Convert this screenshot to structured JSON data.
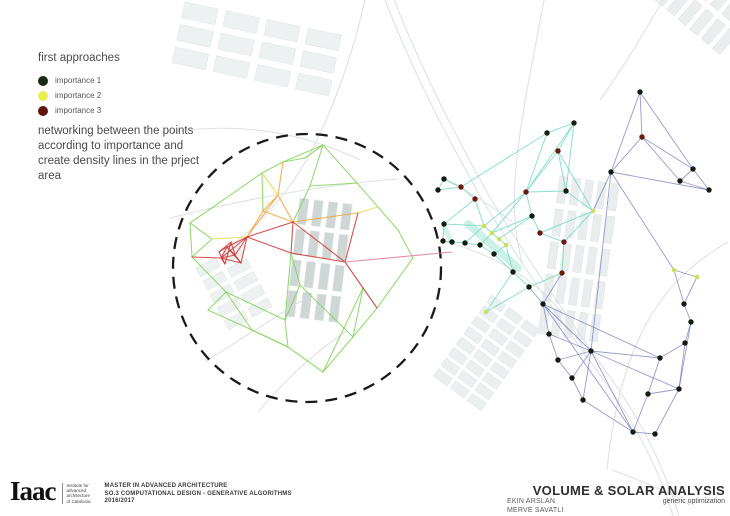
{
  "legend": {
    "title": "first approaches",
    "items": [
      {
        "label": "importance 1",
        "color": "#1a2a12"
      },
      {
        "label": "importance 2",
        "color": "#e9ee52"
      },
      {
        "label": "importance 3",
        "color": "#5f150d"
      }
    ]
  },
  "description": "networking between the points according to importance and create density lines in the prject area",
  "footer": {
    "logo_text": "Iaac",
    "institute_lines": [
      "Institute for",
      "advanced",
      "architecture",
      "of Catalonia"
    ],
    "program_lines": [
      "MASTER IN ADVANCED ARCHITECTURE",
      "SO.3 COMPUTATIONAL DESIGN - GENERATIVE ALGORITHMS",
      "2016/2017"
    ]
  },
  "titleblock": {
    "title": "VOLUME & SOLAR ANALYSIS",
    "subtitle": "generic optimization",
    "credits": [
      "EKIN ARSLAN",
      "MERVE SAVATLI"
    ]
  },
  "chart_data": {
    "type": "network-diagram-over-map",
    "project_circle": {
      "cx": 307,
      "cy": 268,
      "r": 134,
      "stroke": "#1a1a1a",
      "dash": "12 8"
    },
    "density_bands": [
      {
        "x1": 468,
        "y1": 224,
        "x2": 518,
        "y2": 268,
        "color": "#8fe0c8",
        "width": 8,
        "opacity": 0.45
      },
      {
        "x1": 444,
        "y1": 226,
        "x2": 452,
        "y2": 243,
        "color": "#8fe0c8",
        "width": 5,
        "opacity": 0.4
      }
    ],
    "left_network": {
      "line_colors": {
        "g": "#82d45c",
        "o": "#f0a437",
        "y": "#e3d94f",
        "r": "#d23c3c",
        "p": "#e078a0"
      },
      "nodes": [
        [
          323,
          145
        ],
        [
          283,
          162
        ],
        [
          262,
          173
        ],
        [
          305,
          158
        ],
        [
          357,
          183
        ],
        [
          378,
          207
        ],
        [
          398,
          230
        ],
        [
          413,
          258
        ],
        [
          190,
          223
        ],
        [
          192,
          257
        ],
        [
          212,
          239
        ],
        [
          247,
          237
        ],
        [
          227,
          247
        ],
        [
          235,
          255
        ],
        [
          221,
          258
        ],
        [
          241,
          263
        ],
        [
          293,
          222
        ],
        [
          278,
          195
        ],
        [
          263,
          211
        ],
        [
          291,
          253
        ],
        [
          345,
          262
        ],
        [
          363,
          288
        ],
        [
          358,
          213
        ],
        [
          285,
          320
        ],
        [
          288,
          347
        ],
        [
          323,
          372
        ],
        [
          353,
          337
        ],
        [
          377,
          308
        ],
        [
          226,
          292
        ],
        [
          208,
          310
        ],
        [
          252,
          330
        ],
        [
          452,
          252
        ],
        [
          310,
          186
        ],
        [
          300,
          285
        ],
        [
          219,
          252
        ],
        [
          231,
          242
        ],
        [
          225,
          264
        ]
      ],
      "edges": [
        [
          0,
          1,
          "g"
        ],
        [
          1,
          2,
          "g"
        ],
        [
          0,
          3,
          "g"
        ],
        [
          3,
          1,
          "g"
        ],
        [
          0,
          4,
          "g"
        ],
        [
          4,
          5,
          "g"
        ],
        [
          5,
          6,
          "g"
        ],
        [
          6,
          7,
          "g"
        ],
        [
          0,
          32,
          "g"
        ],
        [
          32,
          16,
          "g"
        ],
        [
          32,
          4,
          "g"
        ],
        [
          2,
          18,
          "g"
        ],
        [
          2,
          8,
          "g"
        ],
        [
          8,
          9,
          "g"
        ],
        [
          8,
          10,
          "g"
        ],
        [
          9,
          10,
          "g"
        ],
        [
          9,
          28,
          "g"
        ],
        [
          28,
          29,
          "g"
        ],
        [
          29,
          30,
          "g"
        ],
        [
          28,
          23,
          "g"
        ],
        [
          30,
          24,
          "g"
        ],
        [
          23,
          24,
          "g"
        ],
        [
          24,
          25,
          "g"
        ],
        [
          25,
          26,
          "g"
        ],
        [
          26,
          27,
          "g"
        ],
        [
          27,
          7,
          "g"
        ],
        [
          23,
          33,
          "g"
        ],
        [
          33,
          19,
          "g"
        ],
        [
          33,
          26,
          "g"
        ],
        [
          25,
          21,
          "g"
        ],
        [
          26,
          21,
          "g"
        ],
        [
          19,
          23,
          "g"
        ],
        [
          28,
          30,
          "g"
        ],
        [
          24,
          30,
          "g"
        ],
        [
          1,
          17,
          "o"
        ],
        [
          17,
          16,
          "o"
        ],
        [
          17,
          11,
          "o"
        ],
        [
          18,
          16,
          "o"
        ],
        [
          18,
          11,
          "o"
        ],
        [
          17,
          18,
          "o"
        ],
        [
          16,
          22,
          "o"
        ],
        [
          22,
          5,
          "y"
        ],
        [
          10,
          11,
          "y"
        ],
        [
          2,
          17,
          "y"
        ],
        [
          11,
          12,
          "r"
        ],
        [
          11,
          13,
          "r"
        ],
        [
          11,
          14,
          "r"
        ],
        [
          11,
          15,
          "r"
        ],
        [
          12,
          13,
          "r"
        ],
        [
          13,
          14,
          "r"
        ],
        [
          12,
          15,
          "r"
        ],
        [
          14,
          15,
          "r"
        ],
        [
          12,
          14,
          "r"
        ],
        [
          13,
          15,
          "r"
        ],
        [
          34,
          35,
          "r"
        ],
        [
          35,
          36,
          "r"
        ],
        [
          34,
          36,
          "r"
        ],
        [
          34,
          12,
          "r"
        ],
        [
          35,
          13,
          "r"
        ],
        [
          36,
          14,
          "r"
        ],
        [
          11,
          16,
          "r"
        ],
        [
          16,
          19,
          "r"
        ],
        [
          19,
          20,
          "r"
        ],
        [
          16,
          20,
          "r"
        ],
        [
          20,
          22,
          "r"
        ],
        [
          20,
          21,
          "r"
        ],
        [
          21,
          27,
          "r"
        ],
        [
          11,
          19,
          "r"
        ],
        [
          14,
          9,
          "r"
        ],
        [
          20,
          31,
          "p"
        ]
      ]
    },
    "right_network": {
      "node_colors": {
        "k": "#131c10",
        "r": "#6b1a10",
        "y": "#c8e05a"
      },
      "edge_colors": {
        "t": "#7ad9c3",
        "b": "#6a6fb8"
      },
      "nodes": [
        [
          640,
          92,
          "k"
        ],
        [
          574,
          123,
          "k"
        ],
        [
          547,
          133,
          "k"
        ],
        [
          611,
          172,
          "k"
        ],
        [
          693,
          169,
          "k"
        ],
        [
          680,
          181,
          "k"
        ],
        [
          709,
          190,
          "k"
        ],
        [
          444,
          179,
          "k"
        ],
        [
          438,
          190,
          "k"
        ],
        [
          526,
          192,
          "r"
        ],
        [
          566,
          191,
          "k"
        ],
        [
          532,
          216,
          "k"
        ],
        [
          444,
          224,
          "k"
        ],
        [
          443,
          241,
          "k"
        ],
        [
          452,
          242,
          "k"
        ],
        [
          465,
          243,
          "k"
        ],
        [
          480,
          245,
          "k"
        ],
        [
          494,
          254,
          "k"
        ],
        [
          513,
          272,
          "k"
        ],
        [
          529,
          287,
          "k"
        ],
        [
          543,
          304,
          "k"
        ],
        [
          549,
          334,
          "k"
        ],
        [
          558,
          360,
          "k"
        ],
        [
          572,
          378,
          "k"
        ],
        [
          583,
          400,
          "k"
        ],
        [
          591,
          351,
          "k"
        ],
        [
          633,
          432,
          "k"
        ],
        [
          655,
          434,
          "k"
        ],
        [
          648,
          394,
          "k"
        ],
        [
          679,
          389,
          "k"
        ],
        [
          660,
          358,
          "k"
        ],
        [
          685,
          343,
          "k"
        ],
        [
          691,
          322,
          "k"
        ],
        [
          684,
          304,
          "k"
        ],
        [
          558,
          151,
          "r"
        ],
        [
          642,
          137,
          "r"
        ],
        [
          461,
          187,
          "r"
        ],
        [
          475,
          199,
          "r"
        ],
        [
          540,
          233,
          "r"
        ],
        [
          564,
          242,
          "r"
        ],
        [
          562,
          273,
          "r"
        ],
        [
          484,
          226,
          "y"
        ],
        [
          492,
          233,
          "y"
        ],
        [
          499,
          239,
          "y"
        ],
        [
          506,
          245,
          "y"
        ],
        [
          593,
          211,
          "y"
        ],
        [
          674,
          270,
          "y"
        ],
        [
          697,
          277,
          "y"
        ],
        [
          486,
          312,
          "y"
        ]
      ],
      "edges": [
        [
          1,
          2,
          "t"
        ],
        [
          1,
          34,
          "t"
        ],
        [
          1,
          10,
          "t"
        ],
        [
          1,
          9,
          "t"
        ],
        [
          2,
          9,
          "t"
        ],
        [
          2,
          36,
          "t"
        ],
        [
          34,
          10,
          "t"
        ],
        [
          34,
          45,
          "t"
        ],
        [
          10,
          45,
          "t"
        ],
        [
          9,
          10,
          "t"
        ],
        [
          9,
          11,
          "t"
        ],
        [
          9,
          41,
          "t"
        ],
        [
          9,
          42,
          "t"
        ],
        [
          11,
          38,
          "t"
        ],
        [
          11,
          42,
          "t"
        ],
        [
          11,
          43,
          "t"
        ],
        [
          38,
          45,
          "t"
        ],
        [
          38,
          39,
          "t"
        ],
        [
          39,
          45,
          "t"
        ],
        [
          39,
          40,
          "t"
        ],
        [
          36,
          37,
          "t"
        ],
        [
          36,
          8,
          "t"
        ],
        [
          36,
          7,
          "t"
        ],
        [
          7,
          8,
          "t"
        ],
        [
          37,
          41,
          "t"
        ],
        [
          37,
          12,
          "t"
        ],
        [
          12,
          13,
          "t"
        ],
        [
          12,
          41,
          "t"
        ],
        [
          41,
          42,
          "t"
        ],
        [
          42,
          43,
          "t"
        ],
        [
          43,
          44,
          "t"
        ],
        [
          44,
          17,
          "t"
        ],
        [
          13,
          14,
          "t"
        ],
        [
          14,
          15,
          "t"
        ],
        [
          15,
          16,
          "t"
        ],
        [
          16,
          17,
          "t"
        ],
        [
          17,
          18,
          "t"
        ],
        [
          18,
          19,
          "t"
        ],
        [
          16,
          42,
          "t"
        ],
        [
          15,
          41,
          "t"
        ],
        [
          18,
          44,
          "t"
        ],
        [
          40,
          19,
          "t"
        ],
        [
          18,
          48,
          "t"
        ],
        [
          48,
          19,
          "t"
        ],
        [
          34,
          9,
          "t"
        ],
        [
          0,
          3,
          "b"
        ],
        [
          0,
          35,
          "b"
        ],
        [
          0,
          4,
          "b"
        ],
        [
          35,
          3,
          "b"
        ],
        [
          35,
          4,
          "b"
        ],
        [
          35,
          5,
          "b"
        ],
        [
          4,
          5,
          "b"
        ],
        [
          4,
          6,
          "b"
        ],
        [
          5,
          6,
          "b"
        ],
        [
          3,
          6,
          "b"
        ],
        [
          3,
          25,
          "b"
        ],
        [
          3,
          46,
          "b"
        ],
        [
          46,
          47,
          "b"
        ],
        [
          47,
          33,
          "b"
        ],
        [
          46,
          33,
          "b"
        ],
        [
          33,
          32,
          "b"
        ],
        [
          32,
          31,
          "b"
        ],
        [
          31,
          30,
          "b"
        ],
        [
          30,
          25,
          "b"
        ],
        [
          31,
          29,
          "b"
        ],
        [
          30,
          28,
          "b"
        ],
        [
          29,
          28,
          "b"
        ],
        [
          28,
          26,
          "b"
        ],
        [
          26,
          27,
          "b"
        ],
        [
          27,
          29,
          "b"
        ],
        [
          26,
          25,
          "b"
        ],
        [
          25,
          20,
          "b"
        ],
        [
          25,
          21,
          "b"
        ],
        [
          25,
          22,
          "b"
        ],
        [
          25,
          23,
          "b"
        ],
        [
          25,
          24,
          "b"
        ],
        [
          20,
          21,
          "b"
        ],
        [
          21,
          22,
          "b"
        ],
        [
          22,
          23,
          "b"
        ],
        [
          23,
          24,
          "b"
        ],
        [
          24,
          26,
          "b"
        ],
        [
          25,
          29,
          "b"
        ],
        [
          20,
          30,
          "b"
        ],
        [
          20,
          26,
          "b"
        ],
        [
          32,
          29,
          "b"
        ],
        [
          19,
          20,
          "b"
        ],
        [
          45,
          3,
          "b"
        ],
        [
          40,
          20,
          "b"
        ]
      ]
    }
  }
}
